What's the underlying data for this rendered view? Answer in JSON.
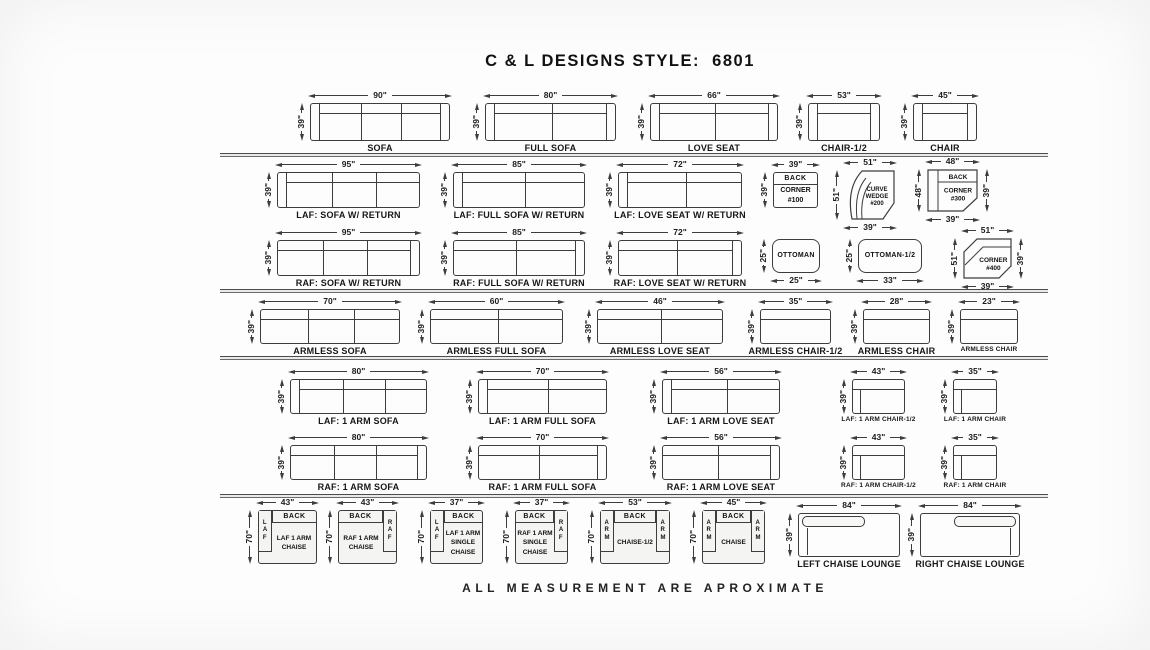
{
  "title": "C & L DESIGNS STYLE:  6801",
  "footer": "ALL MEASUREMENT ARE APROXIMATE",
  "colors": {
    "ink": "#3d3d3d",
    "paper": "#fdfdfd",
    "text": "#111111"
  },
  "separators": [
    {
      "x": 220,
      "y": 153,
      "w": 828
    },
    {
      "x": 220,
      "y": 289,
      "w": 828
    },
    {
      "x": 220,
      "y": 356,
      "w": 828
    },
    {
      "x": 220,
      "y": 494,
      "w": 828
    }
  ],
  "pieces": [
    {
      "name": "sofa",
      "kind": "sofa",
      "label": "SOFA",
      "x": 310,
      "y": 103,
      "w": 140,
      "h": 38,
      "seats": 3,
      "arm": "both",
      "dims": {
        "t": "90\"",
        "l": "39\""
      }
    },
    {
      "name": "full-sofa",
      "kind": "sofa",
      "label": "FULL SOFA",
      "x": 485,
      "y": 103,
      "w": 131,
      "h": 38,
      "seats": 2,
      "arm": "both",
      "dims": {
        "t": "80\"",
        "l": "39\""
      }
    },
    {
      "name": "love-seat",
      "kind": "sofa",
      "label": "LOVE SEAT",
      "x": 650,
      "y": 103,
      "w": 128,
      "h": 38,
      "seats": 2,
      "arm": "both",
      "dims": {
        "t": "66\"",
        "l": "39\""
      }
    },
    {
      "name": "chair-half",
      "kind": "sofa",
      "label": "CHAIR-1/2",
      "x": 808,
      "y": 103,
      "w": 72,
      "h": 38,
      "seats": 1,
      "arm": "both",
      "dims": {
        "t": "53\"",
        "l": "39\""
      }
    },
    {
      "name": "chair",
      "kind": "sofa",
      "label": "CHAIR",
      "x": 913,
      "y": 103,
      "w": 64,
      "h": 38,
      "seats": 1,
      "arm": "both",
      "dims": {
        "t": "45\"",
        "l": "39\""
      }
    },
    {
      "name": "laf-sofa-w-return",
      "kind": "sofa",
      "label": "LAF: SOFA W/ RETURN",
      "x": 277,
      "y": 172,
      "w": 143,
      "h": 36,
      "seats": 3,
      "arm": "left",
      "dims": {
        "t": "95\"",
        "l": "39\""
      }
    },
    {
      "name": "laf-full-sofa-w-return",
      "kind": "sofa",
      "label": "LAF: FULL SOFA W/ RETURN",
      "x": 453,
      "y": 172,
      "w": 132,
      "h": 36,
      "seats": 2,
      "arm": "left",
      "dims": {
        "t": "85\"",
        "l": "39\""
      }
    },
    {
      "name": "laf-love-seat-w-return",
      "kind": "sofa",
      "label": "LAF: LOVE SEAT W/ RETURN",
      "x": 618,
      "y": 172,
      "w": 124,
      "h": 36,
      "seats": 2,
      "arm": "left",
      "dims": {
        "t": "72\"",
        "l": "39\""
      }
    },
    {
      "name": "back-corner-100",
      "kind": "box",
      "x": 773,
      "y": 172,
      "w": 45,
      "h": 36,
      "back": "BACK",
      "lines": "CORNER\n#100",
      "dims": {
        "t": "39\"",
        "l": "39\""
      }
    },
    {
      "name": "curve-wedge-200",
      "kind": "wedge",
      "x": 845,
      "y": 170,
      "w": 50,
      "h": 50,
      "lines": "CURVE\nWEDGE\n#200",
      "dims": {
        "t": "51\"",
        "l": "51\"",
        "b": "39\""
      }
    },
    {
      "name": "back-corner-300",
      "kind": "corner300",
      "x": 927,
      "y": 169,
      "w": 51,
      "h": 43,
      "back": "BACK",
      "lines": "CORNER\n#300",
      "dims": {
        "t": "48\"",
        "l": "48\"",
        "r": "39\"",
        "b": "39\""
      }
    },
    {
      "name": "raf-sofa-w-return",
      "kind": "sofa",
      "label": "RAF: SOFA W/ RETURN",
      "x": 277,
      "y": 240,
      "w": 143,
      "h": 36,
      "seats": 3,
      "arm": "right",
      "dims": {
        "t": "95\"",
        "l": "39\""
      }
    },
    {
      "name": "raf-full-sofa-w-return",
      "kind": "sofa",
      "label": "RAF: FULL SOFA W/ RETURN",
      "x": 453,
      "y": 240,
      "w": 132,
      "h": 36,
      "seats": 2,
      "arm": "right",
      "dims": {
        "t": "85\"",
        "l": "39\""
      }
    },
    {
      "name": "raf-love-seat-w-return",
      "kind": "sofa",
      "label": "RAF: LOVE SEAT W/ RETURN",
      "x": 618,
      "y": 240,
      "w": 124,
      "h": 36,
      "seats": 2,
      "arm": "right",
      "dims": {
        "t": "72\"",
        "l": "39\""
      }
    },
    {
      "name": "ottoman",
      "kind": "ottoman",
      "x": 772,
      "y": 239,
      "w": 48,
      "h": 34,
      "lines": "OTTOMAN",
      "dims": {
        "l": "25\"",
        "b": "25\""
      }
    },
    {
      "name": "ottoman-half",
      "kind": "ottoman",
      "x": 858,
      "y": 239,
      "w": 64,
      "h": 34,
      "lines": "OTTOMAN-1/2",
      "dims": {
        "l": "25\"",
        "b": "33\""
      }
    },
    {
      "name": "corner-400",
      "kind": "corner400",
      "x": 963,
      "y": 238,
      "w": 49,
      "h": 41,
      "lines": "CORNER\n#400",
      "dims": {
        "t": "51\"",
        "l": "51\"",
        "r": "39\"",
        "b": "39\""
      }
    },
    {
      "name": "armless-sofa",
      "kind": "sofa",
      "label": "ARMLESS SOFA",
      "x": 260,
      "y": 309,
      "w": 140,
      "h": 35,
      "seats": 3,
      "arm": "none",
      "dims": {
        "t": "70\"",
        "l": "39\""
      }
    },
    {
      "name": "armless-full-sofa",
      "kind": "sofa",
      "label": "ARMLESS FULL SOFA",
      "x": 430,
      "y": 309,
      "w": 133,
      "h": 35,
      "seats": 2,
      "arm": "none",
      "dims": {
        "t": "60\"",
        "l": "39\""
      }
    },
    {
      "name": "armless-love-seat",
      "kind": "sofa",
      "label": "ARMLESS LOVE SEAT",
      "x": 597,
      "y": 309,
      "w": 126,
      "h": 35,
      "seats": 2,
      "arm": "none",
      "dims": {
        "t": "46\"",
        "l": "39\""
      }
    },
    {
      "name": "armless-chair-half",
      "kind": "sofa",
      "label": "ARMLESS CHAIR-1/2",
      "x": 760,
      "y": 309,
      "w": 71,
      "h": 35,
      "seats": 1,
      "arm": "none",
      "dims": {
        "t": "35\"",
        "l": "39\""
      }
    },
    {
      "name": "armless-chair-28",
      "kind": "sofa",
      "label": "ARMLESS CHAIR",
      "x": 863,
      "y": 309,
      "w": 67,
      "h": 35,
      "seats": 1,
      "arm": "none",
      "dims": {
        "t": "28\"",
        "l": "39\""
      }
    },
    {
      "name": "armless-chair-23",
      "kind": "sofa",
      "label": "ARMLESS CHAIR",
      "x": 960,
      "y": 309,
      "w": 58,
      "h": 35,
      "seats": 1,
      "arm": "none",
      "dims": {
        "t": "23\"",
        "l": "39\""
      }
    },
    {
      "name": "laf-1-arm-sofa",
      "kind": "sofa",
      "label": "LAF: 1 ARM SOFA",
      "x": 290,
      "y": 379,
      "w": 137,
      "h": 35,
      "seats": 3,
      "arm": "left",
      "dims": {
        "t": "80\"",
        "l": "39\""
      }
    },
    {
      "name": "laf-1-arm-full-sofa",
      "kind": "sofa",
      "label": "LAF: 1 ARM FULL SOFA",
      "x": 478,
      "y": 379,
      "w": 129,
      "h": 35,
      "seats": 2,
      "arm": "left",
      "dims": {
        "t": "70\"",
        "l": "39\""
      }
    },
    {
      "name": "laf-1-arm-love-seat",
      "kind": "sofa",
      "label": "LAF: 1 ARM LOVE SEAT",
      "x": 662,
      "y": 379,
      "w": 118,
      "h": 35,
      "seats": 2,
      "arm": "left",
      "dims": {
        "t": "56\"",
        "l": "39\""
      }
    },
    {
      "name": "laf-1-arm-chair-half",
      "kind": "chair",
      "label": "LAF: 1 ARM CHAIR-1/2",
      "x": 852,
      "y": 379,
      "w": 53,
      "h": 35,
      "dims": {
        "t": "43\"",
        "l": "39\""
      }
    },
    {
      "name": "laf-1-arm-chair",
      "kind": "chair",
      "label": "LAF: 1 ARM CHAIR",
      "x": 953,
      "y": 379,
      "w": 44,
      "h": 35,
      "dims": {
        "t": "35\"",
        "l": "39\""
      }
    },
    {
      "name": "raf-1-arm-sofa",
      "kind": "sofa",
      "label": "RAF: 1 ARM SOFA",
      "x": 290,
      "y": 445,
      "w": 137,
      "h": 35,
      "seats": 3,
      "arm": "right",
      "dims": {
        "t": "80\"",
        "l": "39\""
      }
    },
    {
      "name": "raf-1-arm-full-sofa",
      "kind": "sofa",
      "label": "RAF: 1 ARM FULL SOFA",
      "x": 478,
      "y": 445,
      "w": 129,
      "h": 35,
      "seats": 2,
      "arm": "right",
      "dims": {
        "t": "70\"",
        "l": "39\""
      }
    },
    {
      "name": "raf-1-arm-love-seat",
      "kind": "sofa",
      "label": "RAF: 1 ARM LOVE SEAT",
      "x": 662,
      "y": 445,
      "w": 118,
      "h": 35,
      "seats": 2,
      "arm": "right",
      "dims": {
        "t": "56\"",
        "l": "39\""
      }
    },
    {
      "name": "raf-1-arm-chair-half",
      "kind": "chair",
      "label": "RAF: 1 ARM CHAIR-1/2",
      "x": 852,
      "y": 445,
      "w": 53,
      "h": 35,
      "dims": {
        "t": "43\"",
        "l": "39\""
      }
    },
    {
      "name": "raf-1-arm-chair",
      "kind": "chair",
      "label": "RAF: 1 ARM CHAIR",
      "x": 953,
      "y": 445,
      "w": 44,
      "h": 35,
      "dims": {
        "t": "35\"",
        "l": "39\""
      }
    },
    {
      "name": "laf-1-arm-chaise",
      "kind": "chaise",
      "x": 258,
      "y": 510,
      "w": 59,
      "h": 54,
      "side": "left",
      "side_text": "LAF",
      "back": "BACK",
      "lines": "LAF 1 ARM\nCHAISE",
      "dims": {
        "t": "43\"",
        "l": "70\""
      }
    },
    {
      "name": "raf-1-arm-chaise",
      "kind": "chaise",
      "x": 338,
      "y": 510,
      "w": 59,
      "h": 54,
      "side": "right",
      "side_text": "RAF",
      "back": "BACK",
      "lines": "RAF 1 ARM\nCHAISE",
      "dims": {
        "t": "43\"",
        "l": "70\""
      }
    },
    {
      "name": "laf-1-arm-single-chaise",
      "kind": "chaise",
      "x": 430,
      "y": 510,
      "w": 53,
      "h": 54,
      "side": "left",
      "side_text": "LAF",
      "back": "BACK",
      "lines": "LAF 1 ARM\nSINGLE\nCHAISE",
      "dims": {
        "t": "37\"",
        "l": "70\""
      }
    },
    {
      "name": "raf-1-arm-single-chaise",
      "kind": "chaise",
      "x": 515,
      "y": 510,
      "w": 53,
      "h": 54,
      "side": "right",
      "side_text": "RAF",
      "back": "BACK",
      "lines": "RAF 1 ARM\nSINGLE\nCHAISE",
      "dims": {
        "t": "37\"",
        "l": "70\""
      }
    },
    {
      "name": "chaise-half",
      "kind": "chaise",
      "x": 600,
      "y": 510,
      "w": 70,
      "h": 54,
      "side": "both",
      "side_text": "ARM",
      "back": "BACK",
      "lines": "CHAISE-1/2",
      "dims": {
        "t": "53\"",
        "l": "70\""
      }
    },
    {
      "name": "chaise-piece",
      "kind": "chaise",
      "x": 702,
      "y": 510,
      "w": 63,
      "h": 54,
      "side": "both",
      "side_text": "ARM",
      "back": "BACK",
      "lines": "CHAISE",
      "dims": {
        "t": "45\"",
        "l": "70\""
      }
    },
    {
      "name": "left-chaise-lounge",
      "kind": "lounge",
      "label": "LEFT CHAISE LOUNGE",
      "x": 798,
      "y": 513,
      "w": 102,
      "h": 44,
      "side": "left",
      "dims": {
        "t": "84\"",
        "l": "39\""
      }
    },
    {
      "name": "right-chaise-lounge",
      "kind": "lounge",
      "label": "RIGHT CHAISE LOUNGE",
      "x": 920,
      "y": 513,
      "w": 100,
      "h": 44,
      "side": "right",
      "dims": {
        "t": "84\"",
        "l": "39\""
      }
    }
  ]
}
